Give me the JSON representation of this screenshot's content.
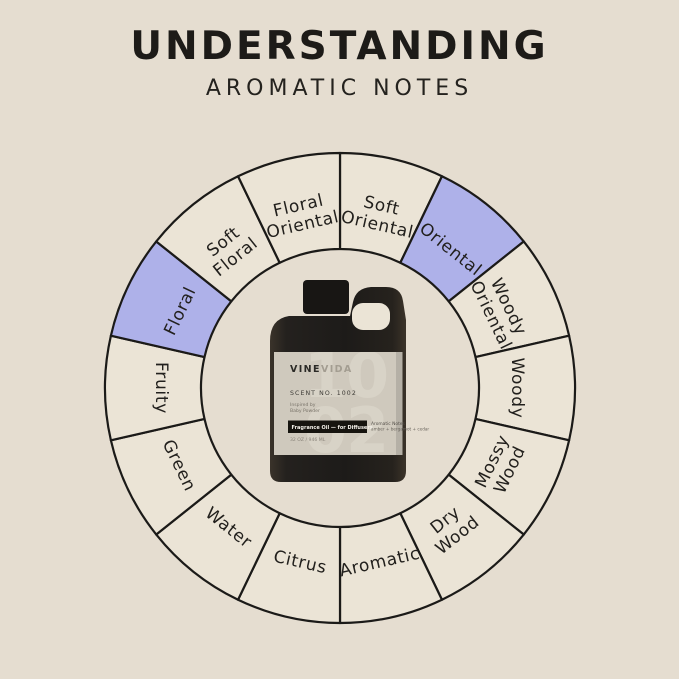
{
  "title": "UNDERSTANDING",
  "subtitle": "AROMATIC NOTES",
  "colors": {
    "background": "#e5ddd0",
    "segment_fill": "#ebe4d6",
    "highlight_fill": "#aeb1e9",
    "outline": "#1b1a18",
    "label_text": "#22201d",
    "bottle_black": "#221f1c",
    "bottle_label": "#cfc9bd"
  },
  "wheel": {
    "segments": [
      {
        "label": "Soft Oriental",
        "lines": [
          "Soft",
          "Oriental"
        ],
        "highlighted": false
      },
      {
        "label": "Oriental",
        "lines": [
          "Oriental"
        ],
        "highlighted": true
      },
      {
        "label": "Woody Oriental",
        "lines": [
          "Woody",
          "Oriental"
        ],
        "highlighted": false
      },
      {
        "label": "Woody",
        "lines": [
          "Woody"
        ],
        "highlighted": false
      },
      {
        "label": "Mossy Wood",
        "lines": [
          "Mossy",
          "Wood"
        ],
        "highlighted": false
      },
      {
        "label": "Dry Wood",
        "lines": [
          "Dry",
          "Wood"
        ],
        "highlighted": false
      },
      {
        "label": "Aromatic",
        "lines": [
          "Aromatic"
        ],
        "highlighted": false
      },
      {
        "label": "Citrus",
        "lines": [
          "Citrus"
        ],
        "highlighted": false
      },
      {
        "label": "Water",
        "lines": [
          "Water"
        ],
        "highlighted": false
      },
      {
        "label": "Green",
        "lines": [
          "Green"
        ],
        "highlighted": false
      },
      {
        "label": "Fruity",
        "lines": [
          "Fruity"
        ],
        "highlighted": false
      },
      {
        "label": "Floral",
        "lines": [
          "Floral"
        ],
        "highlighted": true
      },
      {
        "label": "Soft Floral",
        "lines": [
          "Soft",
          "Floral"
        ],
        "highlighted": false
      },
      {
        "label": "Floral Oriental",
        "lines": [
          "Floral",
          "Oriental"
        ],
        "highlighted": false
      }
    ],
    "highlighted_labels": [
      "Oriental",
      "Floral"
    ]
  },
  "bottle": {
    "brand_bold": "VINE",
    "brand_light": "VIDA",
    "watermark_top": "10",
    "watermark_bottom": "02",
    "scent_no": "SCENT NO. 1002",
    "inspired_label": "Inspired by",
    "inspired_value": "Baby Powder",
    "band_text": "Fragrance Oil — for Diffusers",
    "notes_title": "Aromatic Notes",
    "notes_value": "amber + bergamot + cedar",
    "size_text": "32 OZ / 946 ML"
  }
}
